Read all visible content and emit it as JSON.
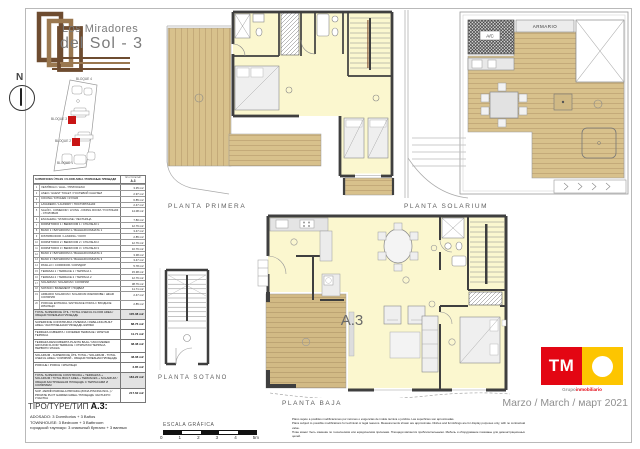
{
  "header": {
    "title_line1": "Los Miradores",
    "title_line2": "del Sol - 3",
    "compass": "N"
  },
  "site_plan": {
    "blocks": [
      "BLOQUE 4",
      "BLOQUE 3",
      "BLOQUE 2",
      "BLOQUE 1"
    ]
  },
  "areas_table": {
    "header": {
      "title": "SUPERFICIES ÚTILES / FLOOR AREA / ПОЛЕЗНЫЕ ПЛОЩАДИ",
      "type": "TIPO/TYPE/ТИП",
      "model": "A.3"
    },
    "rows": [
      {
        "n": "1",
        "label": "VESTÍBULO / HALL / ПРИХОЖАЯ",
        "value": "3.35 m2"
      },
      {
        "n": "2",
        "label": "ASEO / GUEST TOILET / ГОСТЕВОЙ САНУЗЕЛ",
        "value": "2.97 m2"
      },
      {
        "n": "3",
        "label": "COCINA / KITCHEN / КУХНЯ",
        "value": "6.85 m2"
      },
      {
        "n": "4",
        "label": "LAVADERO / LAUNDRY / ПОСТИРОЧНАЯ",
        "value": "2.47 m2"
      },
      {
        "n": "5",
        "label": "SALÓN - COMEDOR / LIVING - DINING ROOM / ГОСТИНАЯ - СТОЛОВАЯ",
        "value": "14.08 m2"
      },
      {
        "n": "6",
        "label": "ESCALERA / STAIRCASE / ЛЕСТНИЦА",
        "value": "7.80 m2"
      },
      {
        "n": "7",
        "label": "DORMITORIO 1 / BEDROOM 1 / СПАЛЬНЯ 1",
        "value": "12.76 m2"
      },
      {
        "n": "8",
        "label": "BAÑO 1 / BATHROOM 1 / ВАННАЯ КОМНАТА 1",
        "value": "3.47 m2"
      },
      {
        "n": "9",
        "label": "DISTRIBUIDOR / LANDING / ХОЛЛ",
        "value": "2.85 m2"
      },
      {
        "n": "10",
        "label": "DORMITORIO 2 / BEDROOM 2 / СПАЛЬНЯ 2",
        "value": "12.76 m2"
      },
      {
        "n": "11",
        "label": "DORMITORIO 3 / BEDROOM 3 / СПАЛЬНЯ 3",
        "value": "10.76 m2"
      },
      {
        "n": "12",
        "label": "BAÑO 2 / BATHROOM 2 / ВАННАЯ КОМНАТА 2",
        "value": "3.38 m2"
      },
      {
        "n": "13",
        "label": "BAÑO 3 / BATHROOM 3 / ВАННАЯ КОМНАТА 3",
        "value": "3.47 m2"
      },
      {
        "n": "14",
        "label": "PASILLO / CORRIDOR / КОРИДОР",
        "value": "5.78 m2"
      },
      {
        "n": "15",
        "label": "TERRAZA 1 / TERRACE 1 / ТЕРРАСА 1",
        "value": "15.38 m2"
      },
      {
        "n": "16",
        "label": "TERRAZA 2 / TERRACE 2 / ТЕРРАСА 2",
        "value": "12.76 m2"
      },
      {
        "n": "17",
        "label": "SOLARIUM / SOLARIUM / СОЛЯРИЙ",
        "value": "38.76 m2"
      },
      {
        "n": "18",
        "label": "SÓTANO / BASEMENT / ПОДВАЛ",
        "value": "11.71 m2"
      },
      {
        "n": "19",
        "label": "ARMARIO SOLARIUM / SOLARIUM WARDROBE / ШКАФ СОЛЯРИЯ",
        "value": "2.47 m2"
      },
      {
        "n": "20",
        "label": "PORCHE ENTRADA / ENTRANCE PORCH / ВХОДНОЕ КРЫЛЬЦО",
        "value": "2.85 m2"
      }
    ],
    "summary_rows": [
      {
        "label": "TOTAL SUPERFICIE ÚTIL / TOTAL USEFUL FLOOR AREA / ОБЩАЯ ПОЛЕЗНАЯ ПЛОЩАДЬ",
        "value": "105.08 m2",
        "shaded": true
      },
      {
        "label": "SUPERFICIE CONSTRUIDA VIVIENDA / DWELLING BUILT AREA / ЗАСТРОЕННАЯ ПЛОЩАДЬ ЖИЛЬЯ",
        "value": "88.76 m2"
      },
      {
        "label": "TERRAZA CUBIERTA / COVERED TERRACE / КРЫТАЯ ТЕРРАСА",
        "value": "11.71 m2"
      },
      {
        "label": "TERRAZA DESCUBIERTA PLANTA BAJA / UNCOVERED GROUND FLOOR TERRACE / ОТКРЫТАЯ ТЕРРАСА ПЕРВОГО ЭТАЖА",
        "value": "38.38 m2"
      },
      {
        "label": "SOLARIUM - SUPERFICIE ÚTIL TOTAL / SOLARIUM - TOTAL USEFUL AREA / СОЛЯРИЙ - ОБЩАЯ ПОЛЕЗНАЯ ПЛОЩАДЬ",
        "value": "48.08 m2"
      },
      {
        "label": "PORCHE / PORCH / КРЫЛЬЦО",
        "value": "2.85 m2"
      },
      {
        "label": "TOTAL SUPERFICIE CONSTRUIDA + TERRAZAS + SOLARIUM / TOTAL BUILT AREA + TERRACES + SOLARIUM / ОБЩАЯ ЗАСТРОЕННАЯ ПЛОЩАДЬ С ТЕРРАСАМИ И СОЛЯРИЕМ",
        "value": "184.22 m2",
        "shaded": true
      },
      {
        "label": "SUP. JARDÍN PARCELA PRIVADA (ZONA PISCINA INCL.) / PRIVATE PLOT GARDEN AREA / ПЛОЩАДЬ ЧАСТНОГО УЧАСТКА",
        "value": "217.62 m2"
      }
    ]
  },
  "plans": {
    "primera": {
      "label": "PLANTA PRIMERA"
    },
    "solarium": {
      "label": "PLANTA SOLARIUM",
      "ac": "A/C",
      "armario": "ARMARIO"
    },
    "baja": {
      "label": "PLANTA BAJA",
      "unit": "A.3"
    },
    "sotano": {
      "label": "PLANTA SOTANO"
    }
  },
  "footer": {
    "type_prefix": "TIPO/TYPE/ТИП",
    "type_value": "A.3:",
    "description_lines": [
      "ADOSADO: 3 Dormitorios + 3 Baños",
      "TOWNHOUSE: 3 Bedroom + 3 Bathroom",
      "городской таунхаус: 3 спальный бунгало + 3 ванных"
    ],
    "scale": {
      "label": "ESCALA GRÁFICA",
      "ticks": [
        "0",
        "1",
        "2",
        "3",
        "4",
        "5m"
      ]
    },
    "disclaimer_lines": [
      "Plano sujeto a posibles modificaciones por razones o exigencias de índole técnica o jurídica. Las superficies son aproximadas.",
      "Plans subject to possible modifications for technical or legal reasons. Measurements shown are approximate. Dishes and furnishings are for display purposes only, with no contractual value.",
      "План может быть изменён по техническим или юридическим причинам. Площади являются приблизительными. Мебель и оборудование показаны для демонстрационных целей."
    ],
    "date": "Marzo / March / март 2021",
    "brand": {
      "tm": "TM",
      "caption_gray": "Grupo",
      "caption_red": "inmobiliario"
    }
  },
  "colors": {
    "brand_red": "#e30613",
    "brand_yellow": "#fdc500",
    "deck": "#d8c18c",
    "room": "#fbf7cf",
    "wall": "#3f3f3f",
    "highlight_red": "#c81414",
    "logo_brown_dark": "#6e4c30",
    "logo_brown_light": "#9a7850"
  }
}
